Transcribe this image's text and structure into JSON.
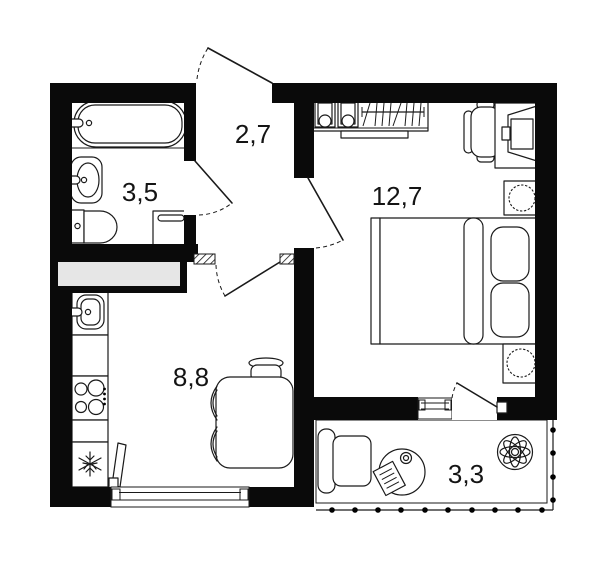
{
  "rooms": {
    "hallway": {
      "name": "hallway",
      "area": "2,7"
    },
    "bathroom": {
      "name": "bathroom",
      "area": "3,5"
    },
    "bedroom": {
      "name": "bedroom",
      "area": "12,7"
    },
    "kitchen": {
      "name": "kitchen",
      "area": "8,8"
    },
    "balcony": {
      "name": "balcony",
      "area": "3,3"
    }
  },
  "colors": {
    "wall": "#0a0a0a",
    "outline": "#1a1a1a",
    "shaft_fill": "#e6e6e6",
    "background": "#ffffff",
    "railing_dot": "#000000"
  },
  "icons": [
    "bathtub-icon",
    "washbasin-icon",
    "toilet-icon",
    "washing-machine-icon",
    "ventilation-shaft",
    "entrance-door-swing",
    "bathroom-door-swing",
    "kitchen-door-swing",
    "bedroom-door-swing",
    "balcony-door-swing",
    "wardrobe-boxes-icon",
    "hanger-rail-icon",
    "desk-icon",
    "office-chair-icon",
    "monitor-icon",
    "nightstand-lamp-icon",
    "double-bed-icon",
    "pillow-icon",
    "kitchen-sink-icon",
    "stove-icon",
    "fridge-snowflake-icon",
    "window-icon",
    "leaning-sash-icon",
    "dining-table-icon",
    "chair-icon",
    "armchair-icon",
    "round-table-icon",
    "book-icon",
    "cup-icon",
    "plant-icon",
    "balcony-railing-dots"
  ]
}
